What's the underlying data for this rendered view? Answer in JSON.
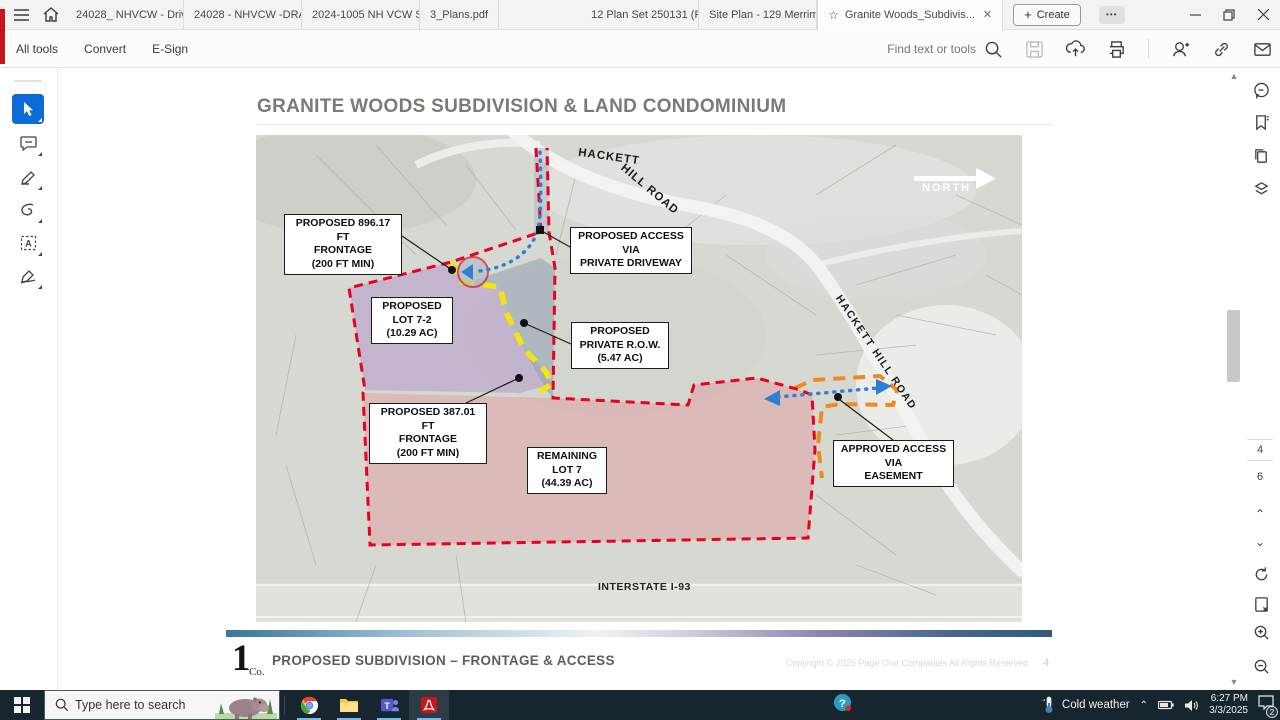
{
  "titlebar": {
    "tabs": [
      {
        "label": "24028_ NHVCW - Driv..."
      },
      {
        "label": "24028 - NHVCW -DRA..."
      },
      {
        "label": "2024-1005 NH VCW Sit..."
      },
      {
        "label": "3_Plans.pdf"
      },
      {
        "label": "12 Plan Set 250131 (Red..."
      },
      {
        "label": "Site Plan - 129 Merrima..."
      }
    ],
    "active_tab": {
      "label": "Granite Woods_Subdivis...",
      "close_glyph": "✕"
    },
    "create_label": "Create",
    "more_glyph": "•••"
  },
  "toolbar": {
    "menu_items": [
      {
        "label": "All tools"
      },
      {
        "label": "Convert"
      },
      {
        "label": "E-Sign"
      }
    ],
    "search_placeholder": "Find text or tools"
  },
  "document": {
    "title": "GRANITE WOODS SUBDIVISION & LAND CONDOMINIUM",
    "map": {
      "road_label_top_1": "HACKETT",
      "road_label_top_2": "HILL ROAD",
      "road_label_right": "HACKETT HILL ROAD",
      "north_label": "NORTH",
      "interstate_label": "INTERSTATE I-93",
      "callouts": [
        {
          "text": "PROPOSED 896.17 FT\nFRONTAGE\n(200 FT MIN)"
        },
        {
          "text": "PROPOSED ACCESS\nVIA\nPRIVATE DRIVEWAY"
        },
        {
          "text": "PROPOSED\nLOT 7-2\n(10.29 AC)"
        },
        {
          "text": "PROPOSED\nPRIVATE R.O.W.\n(5.47 AC)"
        },
        {
          "text": "PROPOSED 387.01 FT\nFRONTAGE\n(200 FT MIN)"
        },
        {
          "text": "REMAINING\nLOT 7\n(44.39 AC)"
        },
        {
          "text": "APPROVED ACCESS\nVIA\nEASEMENT"
        }
      ],
      "colors": {
        "boundary_red": "#e8001c",
        "frontage_yellow": "#f3e50f",
        "easement_orange": "#f08a1e",
        "access_blue": "#2e7fd6",
        "lot72_fill": "#b89fcb",
        "row_fill": "#8fa0b0",
        "lot7_fill": "#dda6a6"
      }
    },
    "footer": {
      "logo_number": "1",
      "logo_suffix": "Co.",
      "heading": "PROPOSED SUBDIVISION – FRONTAGE & ACCESS",
      "copyright": "Copyright © 2025 Page One Companies All Rights Reserved",
      "page_number": "4"
    }
  },
  "pagenav": {
    "current_page": "4",
    "total_pages": "6"
  },
  "taskbar": {
    "search_placeholder": "Type here to search",
    "weather_label": "Cold weather",
    "time": "6:27 PM",
    "date": "3/3/2025",
    "notification_count": "2"
  }
}
